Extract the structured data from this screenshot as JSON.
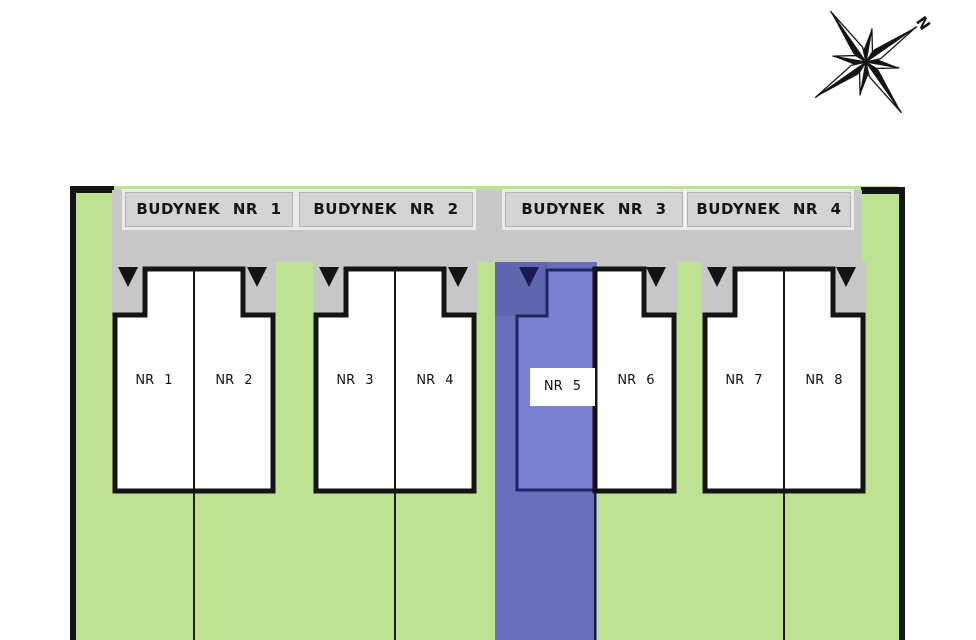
{
  "compass": {
    "north_label": "N"
  },
  "site": {
    "buildings": [
      {
        "label": "BUDYNEK NR 1",
        "units": [
          {
            "label": "NR 1"
          },
          {
            "label": "NR 2"
          }
        ]
      },
      {
        "label": "BUDYNEK NR 2",
        "units": [
          {
            "label": "NR 3"
          },
          {
            "label": "NR 4"
          }
        ]
      },
      {
        "label": "BUDYNEK NR 3",
        "units": [
          {
            "label": "NR 5",
            "highlighted": true
          },
          {
            "label": "NR 6"
          }
        ]
      },
      {
        "label": "BUDYNEK NR 4",
        "units": [
          {
            "label": "NR 7"
          },
          {
            "label": "NR 8"
          }
        ]
      }
    ],
    "highlight": {
      "unit": "NR 5",
      "band_color": "#6a6ebc",
      "unit_fill": "#7c80d3",
      "unit_outline": "#232364"
    },
    "colors": {
      "lawn": "#bde291",
      "road": "#c7c7c7",
      "name_plate": "#d4d4d4",
      "outline": "#141414",
      "building_fill": "#ffffff"
    }
  }
}
